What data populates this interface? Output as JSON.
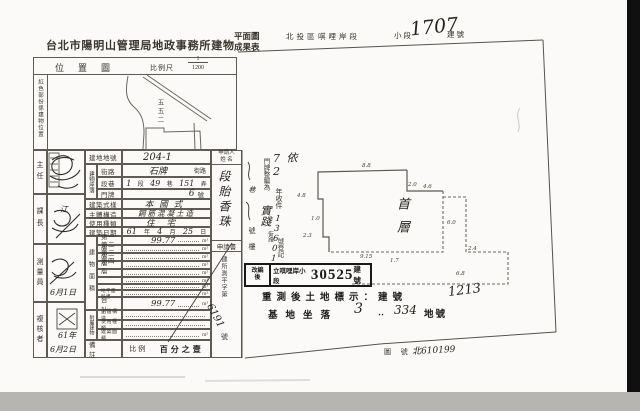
{
  "header": {
    "office_title": "台北市陽明山管理局地政事務所建物",
    "title_top": "平面圖",
    "title_bottom": "成果表",
    "district": "北投區",
    "section": "唭哩岸段",
    "subsection_label": "小段",
    "building_no": "1707",
    "building_no_unit": "建號"
  },
  "location_map": {
    "title": "位置圖",
    "scale_label": "比例尺",
    "scale_num": "1",
    "scale_den": "1200",
    "side_note": "紅色部份係建物位置",
    "lot_label": "五五二"
  },
  "approvals": {
    "roles": [
      "主任",
      "課長",
      "測量員",
      "複核者"
    ],
    "sign2_char": "江",
    "date3": "6月1日",
    "date4_year": "61年",
    "date4_md": "6月2日"
  },
  "table": {
    "lot_no_label": "建地地號",
    "lot_no_value": "204-1",
    "location_group": "建物座落",
    "street_label": "街路",
    "street_value": "石牌",
    "street_unit": "街路",
    "lane_label": "段巷",
    "lane_v1": "1",
    "lane_u1": "段",
    "lane_v2": "49",
    "lane_u2": "巷",
    "lane_v3": "151",
    "lane_u3": "弄",
    "door_label": "門牌",
    "door_value": "6",
    "door_unit": "號",
    "style_label": "建築式樣",
    "style_value": "本國式",
    "structure_label": "主體構造",
    "structure_value": "鋼筋混凝土造",
    "use_label": "使用種類",
    "use_value": "住宅",
    "date_label": "建築日期",
    "date_y": "61",
    "date_y_u": "年",
    "date_m": "4",
    "date_m_u": "月",
    "date_d": "25",
    "date_d_u": "日",
    "area_group": "建物面積",
    "floors": [
      {
        "label": "第一層",
        "value": "99.77",
        "unit": "m²"
      },
      {
        "label": "第二層",
        "value": "",
        "unit": "m²"
      },
      {
        "label": "第三層",
        "value": "",
        "unit": "m²"
      },
      {
        "label": "第四層",
        "value": "",
        "unit": "m²"
      },
      {
        "label": "",
        "value": "",
        "unit": "m²"
      },
      {
        "label": "",
        "value": "",
        "unit": "m²"
      },
      {
        "label": "",
        "value": "",
        "unit": "m²"
      },
      {
        "label": "地平面騎樓",
        "value": "",
        "unit": "m²"
      },
      {
        "label": "合計",
        "value": "99.77",
        "unit": "m²"
      }
    ],
    "annex_group": "附屬建物",
    "annex": [
      {
        "label": "主體構造",
        "value": "",
        "unit": ""
      },
      {
        "label": "使用種類",
        "value": "",
        "unit": ""
      },
      {
        "label": "建築面積",
        "value": "",
        "unit": "m²"
      }
    ],
    "remarks_label": "備註",
    "scale_prefix": "比例",
    "scale_text": "百分之壹"
  },
  "applicant": {
    "header_l1": "申請人",
    "header_l2": "姓 名",
    "name": "段貽香珠",
    "doc_label": "申請書",
    "doc_prefix": "建所測平字第",
    "doc_no": "6191",
    "doc_unit": "號"
  },
  "annotations": {
    "reg_hw": "依72",
    "reg_mid": "年收件",
    "reg_no": "13601",
    "reg_suffix": "號登記",
    "renum_label": "門牌整編為",
    "renum_street": "實踐",
    "renum_unit": "街路",
    "addr_lane": "巷",
    "addr_no": "號",
    "addr_floor": "樓"
  },
  "plan": {
    "floor_label": "首層",
    "dims": {
      "top": "8.8",
      "step1": "2.0",
      "step2": "4.6",
      "right": "6.0",
      "ext1": "2.4",
      "ext2": "6.8",
      "bottom1": "9.15",
      "bottom2": "1.7",
      "left1": "4.8",
      "left2": "1.0",
      "left3": "2.3"
    }
  },
  "stamp": {
    "left_l1": "改編",
    "left_l2": "後",
    "body_prefix": "立唭哩岸小段",
    "number": "30525",
    "unit": "建號"
  },
  "footer": {
    "resurvey_text": "重測後土地標示：建號",
    "resurvey_no": "1213",
    "site_text": "基地坐落",
    "site_no1": "3",
    "site_dots": "‥",
    "site_no2": "334",
    "site_unit": "地號",
    "map_no_label": "圖 號",
    "map_no_value": "北610199"
  }
}
